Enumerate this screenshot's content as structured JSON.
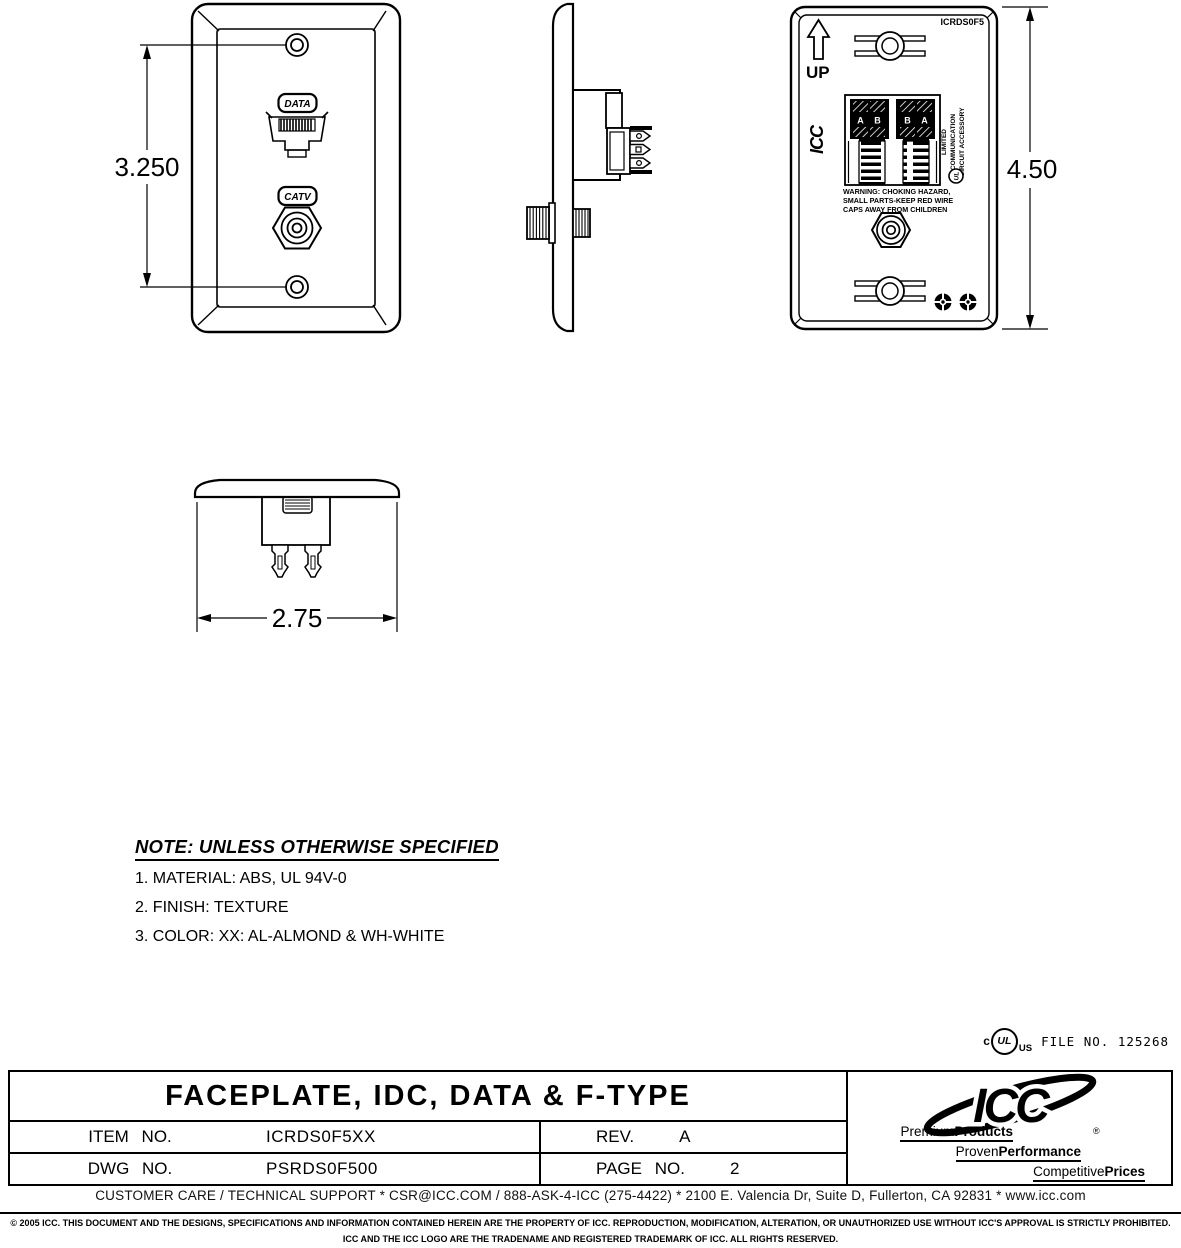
{
  "meta": {
    "ink_color": "#000000",
    "paper_color": "#ffffff"
  },
  "views": {
    "front": {
      "dim_label": "3.250",
      "data_badge": "DATA",
      "catv_badge": "CATV"
    },
    "back": {
      "part_no": "ICRDS0F5",
      "up_label": "UP",
      "dim_label": "4.50",
      "molded_logo": "ICC",
      "idc_letters": [
        "A",
        "B",
        "B",
        "A"
      ],
      "warning_lines": [
        "WARNING: CHOKING HAZARD,",
        "SMALL PARTS-KEEP RED WIRE",
        "CAPS AWAY FROM CHILDREN"
      ],
      "side_text_lines": [
        "LIMITED",
        "COMMUNICATION",
        "CIRCUIT ACCESSORY"
      ]
    },
    "top": {
      "dim_label": "2.75"
    }
  },
  "notes": {
    "heading": "NOTE: UNLESS OTHERWISE SPECIFIED",
    "items": [
      "1. MATERIAL: ABS, UL 94V-0",
      "2. FINISH: TEXTURE",
      "3. COLOR: XX: AL-ALMOND & WH-WHITE"
    ]
  },
  "certification": {
    "c_label": "c",
    "ul_label": "UL",
    "us_label": "US",
    "file_label": "FILE NO. 125268"
  },
  "title_block": {
    "title": "FACEPLATE, IDC, DATA & F-TYPE",
    "rows": [
      {
        "label": "ITEM NO.",
        "value": "ICRDS0F5XX",
        "right_label": "REV.",
        "right_value": "A"
      },
      {
        "label": "DWG NO.",
        "value": "PSRDS0F500",
        "right_label": "PAGE NO.",
        "right_value": "2"
      }
    ],
    "logo": {
      "name": "ICC",
      "registered": "®",
      "taglines": [
        {
          "light": "Premium",
          "bold": "Products"
        },
        {
          "light": "Proven",
          "bold": "Performance"
        },
        {
          "light": "Competitive",
          "bold": "Prices"
        }
      ]
    }
  },
  "footer": {
    "contact": "CUSTOMER CARE / TECHNICAL SUPPORT * CSR@ICC.COM / 888-ASK-4-ICC (275-4422) * 2100 E. Valencia Dr, Suite D, Fullerton, CA 92831 * www.icc.com",
    "copyright_line1": "© 2005 ICC. THIS DOCUMENT AND THE DESIGNS, SPECIFICATIONS AND INFORMATION CONTAINED HEREIN ARE THE PROPERTY OF ICC. REPRODUCTION, MODIFICATION, ALTERATION, OR UNAUTHORIZED USE WITHOUT ICC'S APPROVAL IS STRICTLY PROHIBITED.",
    "copyright_line2": "ICC AND THE ICC LOGO ARE THE TRADENAME AND REGISTERED TRADEMARK OF ICC.  ALL RIGHTS RESERVED."
  }
}
